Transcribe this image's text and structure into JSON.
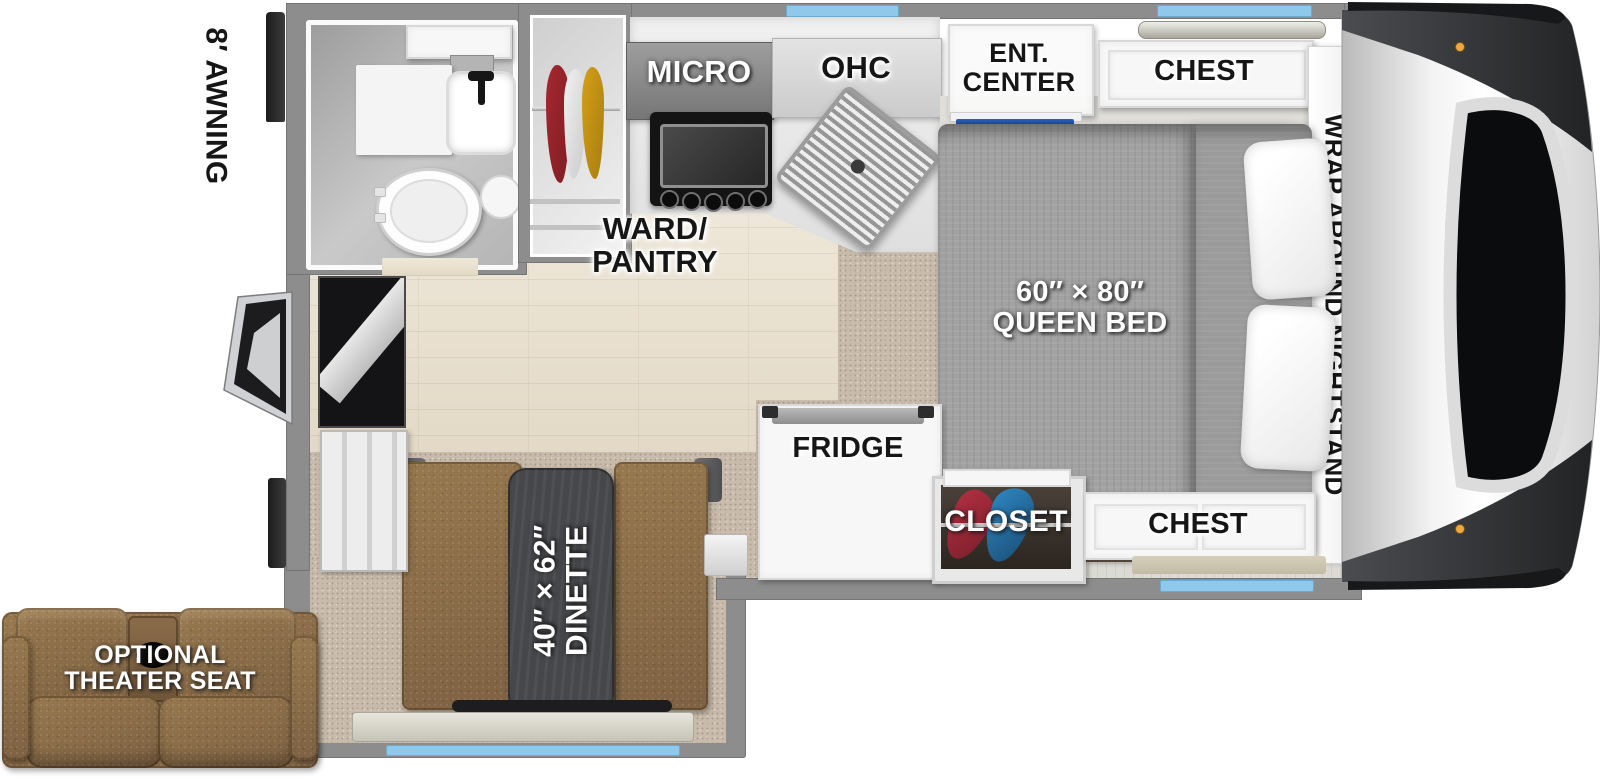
{
  "floorplan": {
    "type": "truck-camper-floorplan",
    "labels": {
      "awning": "8′ AWNING",
      "micro": "MICRO",
      "ohc": "OHC",
      "ent_line1": "ENT.",
      "ent_line2": "CENTER",
      "chest_top": "CHEST",
      "nightstand": "WRAP AROUND NIGHTSTAND",
      "ward_line1": "WARD/",
      "ward_line2": "PANTRY",
      "bed_size": "60″ × 80″",
      "bed_name": "QUEEN BED",
      "fridge": "FRIDGE",
      "closet": "CLOSET",
      "chest_bottom": "CHEST",
      "dinette_size": "40″ × 62″",
      "dinette_name": "DINETTE",
      "theater_line1": "OPTIONAL",
      "theater_line2": "THEATER SEAT"
    },
    "colors": {
      "wall_gray": "#8d8d8d",
      "window_blue": "#8ec9ec",
      "wood_floor": "#eae2d3",
      "carpet_tan": "#c8bbab",
      "leather_brown": "#8c6f4e",
      "comforter_gray": "#a2a2a2",
      "table_dark": "#46474b",
      "tv_blue": "#1f4fae",
      "clothes_red": "#a5282f",
      "clothes_yellow": "#d4a017",
      "closet_clothes_blue": "#2e86c1",
      "clearance_amber": "#f0a73e"
    }
  }
}
